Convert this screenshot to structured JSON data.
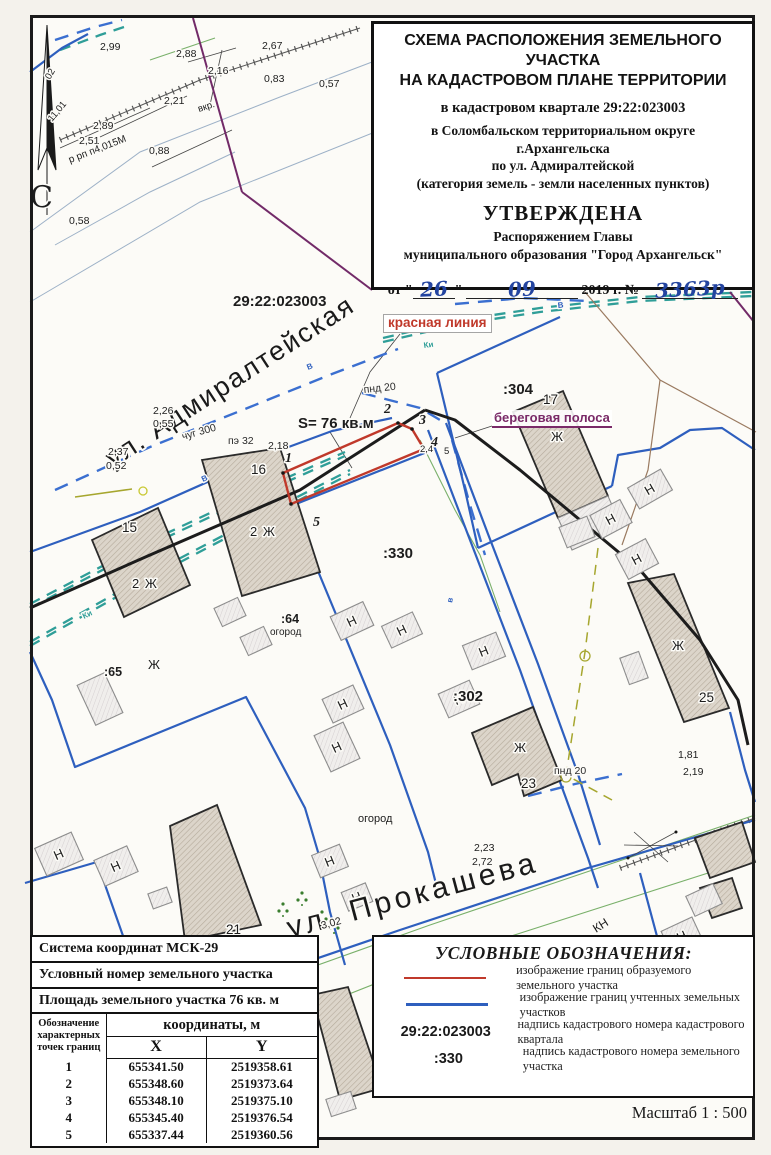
{
  "title_block": {
    "line1": "СХЕМА РАСПОЛОЖЕНИЯ ЗЕМЕЛЬНОГО УЧАСТКА",
    "line2": "НА КАДАСТРОВОМ ПЛАНЕ ТЕРРИТОРИИ",
    "quarter": "в кадастровом квартале 29:22:023003",
    "district": "в Соломбальском территориальном округе",
    "city": "г.Архангельска",
    "street": "по ул. Адмиралтейской",
    "category": "(категория земель - земли населенных пунктов)",
    "approved": "УТВЕРЖДЕНА",
    "order_line1": "Распоряжением Главы",
    "order_line2": "муниципального образования \"Город Архангельск\"",
    "date": {
      "prefix": "от \"",
      "day": "26",
      "quote_close": "\"",
      "month": "09",
      "year_part": "2019 г. №",
      "number": "3363р"
    }
  },
  "callouts": {
    "red_line": "красная линия",
    "shore_strip": "береговая полоса"
  },
  "info_table": {
    "row1": "Система координат МСК-29",
    "row2": "Условный номер земельного участка",
    "row3": "Площадь земельного участка 76 кв. м",
    "col_point": "Обозначение характерных точек границ",
    "col_coords": "координаты, м",
    "col_x": "X",
    "col_y": "Y",
    "points": [
      {
        "n": "1",
        "x": "655341.50",
        "y": "2519358.61"
      },
      {
        "n": "2",
        "x": "655348.60",
        "y": "2519373.64"
      },
      {
        "n": "3",
        "x": "655348.10",
        "y": "2519375.10"
      },
      {
        "n": "4",
        "x": "655345.40",
        "y": "2519376.54"
      },
      {
        "n": "5",
        "x": "655337.44",
        "y": "2519360.56"
      }
    ]
  },
  "legend": {
    "title": "УСЛОВНЫЕ ОБОЗНАЧЕНИЯ:",
    "items": [
      {
        "sample": "red-line",
        "text": "изображение границ образуемого земельного участка"
      },
      {
        "sample": "blue-line",
        "text": "изображение границ учтенных земельных участков"
      },
      {
        "sample": "29:22:023003",
        "text": "надпись кадастрового номера кадастрового квартала"
      },
      {
        "sample": ":330",
        "text": "надпись кадастрового номера земельного участка"
      }
    ]
  },
  "scale_label": "Масштаб  1 : 500",
  "colors": {
    "formed_parcel": "#c0392b",
    "registered_parcel": "#2e5fbe",
    "waterline_teal": "#2f9e98",
    "shore_purple": "#7a2a68",
    "handwriting_blue": "#2344a0"
  },
  "map": {
    "labels": [
      {
        "text": "С",
        "x": 30,
        "y": 207,
        "cls": "north"
      },
      {
        "text": "29:22:023003",
        "x": 233,
        "y": 306,
        "cls": "q"
      },
      {
        "text": "ул. Адмиралтейская",
        "x": 113,
        "y": 468,
        "cls": "street",
        "rot": -33
      },
      {
        "text": "ул. Прокашева",
        "x": 290,
        "y": 938,
        "cls": "street2",
        "rot": -15
      },
      {
        "text": "S= 76 кв.м",
        "x": 298,
        "y": 428,
        "cls": "area"
      },
      {
        "text": ":304",
        "x": 503,
        "y": 394,
        "cls": "q2"
      },
      {
        "text": ":330",
        "x": 383,
        "y": 558,
        "cls": "q2"
      },
      {
        "text": ":302",
        "x": 453,
        "y": 701,
        "cls": "q2"
      },
      {
        "text": ":64",
        "x": 281,
        "y": 623,
        "cls": "q3"
      },
      {
        "text": "огород",
        "x": 270,
        "y": 635,
        "cls": "small"
      },
      {
        "text": ":65",
        "x": 104,
        "y": 676,
        "cls": "q3"
      },
      {
        "text": "огород",
        "x": 358,
        "y": 822,
        "cls": "small2"
      },
      {
        "text": "15",
        "x": 122,
        "y": 532,
        "cls": "hn"
      },
      {
        "text": "16",
        "x": 251,
        "y": 474,
        "cls": "hn"
      },
      {
        "text": "17",
        "x": 543,
        "y": 404,
        "cls": "hn"
      },
      {
        "text": "21",
        "x": 226,
        "y": 934,
        "cls": "hn"
      },
      {
        "text": "23",
        "x": 521,
        "y": 788,
        "cls": "hn"
      },
      {
        "text": "25",
        "x": 699,
        "y": 702,
        "cls": "hn"
      },
      {
        "text": "2 Ж",
        "x": 132,
        "y": 588,
        "cls": "bl"
      },
      {
        "text": "2 Ж",
        "x": 250,
        "y": 536,
        "cls": "bl"
      },
      {
        "text": "Ж",
        "x": 148,
        "y": 669,
        "cls": "bl"
      },
      {
        "text": "Ж",
        "x": 551,
        "y": 441,
        "cls": "bl"
      },
      {
        "text": "Ж",
        "x": 514,
        "y": 752,
        "cls": "bl"
      },
      {
        "text": "Ж",
        "x": 672,
        "y": 650,
        "cls": "bl"
      },
      {
        "text": "1",
        "x": 285,
        "y": 462,
        "cls": "pt"
      },
      {
        "text": "2",
        "x": 384,
        "y": 413,
        "cls": "pt"
      },
      {
        "text": "3",
        "x": 419,
        "y": 424,
        "cls": "pt"
      },
      {
        "text": "4",
        "x": 431,
        "y": 446,
        "cls": "pt"
      },
      {
        "text": "5",
        "x": 313,
        "y": 526,
        "cls": "pt"
      },
      {
        "text": "2,4",
        "x": 420,
        "y": 452,
        "cls": "els"
      },
      {
        "text": "5",
        "x": 444,
        "y": 454,
        "cls": "els"
      },
      {
        "text": "2,18",
        "x": 268,
        "y": 449,
        "cls": "el"
      },
      {
        "text": "2,26",
        "x": 153,
        "y": 414,
        "cls": "el"
      },
      {
        "text": "0,55",
        "x": 153,
        "y": 427,
        "cls": "el"
      },
      {
        "text": "2,37",
        "x": 108,
        "y": 455,
        "cls": "el"
      },
      {
        "text": "0,52",
        "x": 106,
        "y": 469,
        "cls": "el"
      },
      {
        "text": "2,99",
        "x": 100,
        "y": 50,
        "cls": "el"
      },
      {
        "text": "2,88",
        "x": 176,
        "y": 57,
        "cls": "el"
      },
      {
        "text": "2,16",
        "x": 208,
        "y": 74,
        "cls": "el"
      },
      {
        "text": "2,67",
        "x": 262,
        "y": 49,
        "cls": "el"
      },
      {
        "text": "0,83",
        "x": 264,
        "y": 82,
        "cls": "el"
      },
      {
        "text": "0,57",
        "x": 319,
        "y": 87,
        "cls": "el"
      },
      {
        "text": "2,21",
        "x": 164,
        "y": 104,
        "cls": "el"
      },
      {
        "text": "2,89",
        "x": 93,
        "y": 129,
        "cls": "el"
      },
      {
        "text": "2,51",
        "x": 79,
        "y": 144,
        "cls": "el"
      },
      {
        "text": "0,88",
        "x": 149,
        "y": 154,
        "cls": "el"
      },
      {
        "text": "0,58",
        "x": 69,
        "y": 224,
        "cls": "el"
      },
      {
        "text": "11,01",
        "x": 52,
        "y": 122,
        "cls": "els",
        "rot": -50
      },
      {
        "text": "вкр.",
        "x": 199,
        "y": 112,
        "cls": "els",
        "rot": -18
      },
      {
        "text": "р рп п4,015М",
        "x": 70,
        "y": 163,
        "cls": "els2",
        "rot": -21
      },
      {
        "text": "02",
        "x": 50,
        "y": 80,
        "cls": "els",
        "rot": -60
      },
      {
        "text": "1,81",
        "x": 678,
        "y": 758,
        "cls": "el"
      },
      {
        "text": "2,19",
        "x": 683,
        "y": 775,
        "cls": "el"
      },
      {
        "text": "2,23",
        "x": 474,
        "y": 851,
        "cls": "el"
      },
      {
        "text": "2,72",
        "x": 472,
        "y": 865,
        "cls": "el"
      },
      {
        "text": "3,02",
        "x": 322,
        "y": 929,
        "cls": "el",
        "rot": -15
      },
      {
        "text": "чуг 300",
        "x": 183,
        "y": 440,
        "cls": "pipe",
        "rot": -16
      },
      {
        "text": "пэ 32",
        "x": 228,
        "y": 444,
        "cls": "pipe"
      },
      {
        "text": "пнд 20",
        "x": 364,
        "y": 393,
        "cls": "pipe",
        "rot": -6
      },
      {
        "text": "пнд 20",
        "x": 554,
        "y": 774,
        "cls": "pipe"
      },
      {
        "text": "КН",
        "x": 596,
        "y": 933,
        "cls": "pipe2",
        "rot": -32
      },
      {
        "text": "Ки",
        "x": 84,
        "y": 619,
        "cls": "tinyT",
        "rot": -26
      },
      {
        "text": "Ки",
        "x": 424,
        "y": 348,
        "cls": "tinyT",
        "rot": -8
      },
      {
        "text": "В",
        "x": 203,
        "y": 482,
        "cls": "tinyB",
        "rot": -26
      },
      {
        "text": "В",
        "x": 308,
        "y": 370,
        "cls": "tinyB",
        "rot": -22
      },
      {
        "text": "В",
        "x": 558,
        "y": 308,
        "cls": "tinyB",
        "rot": -6
      },
      {
        "text": "в",
        "x": 452,
        "y": 603,
        "cls": "tinyB",
        "rot": -78
      }
    ],
    "small_buildings": [
      {
        "x": 352,
        "y": 621,
        "w": 36,
        "h": 26,
        "rot": -25,
        "label": "Н"
      },
      {
        "x": 402,
        "y": 630,
        "w": 34,
        "h": 24,
        "rot": -25,
        "label": "Н"
      },
      {
        "x": 484,
        "y": 651,
        "w": 36,
        "h": 26,
        "rot": -22,
        "label": "Н"
      },
      {
        "x": 459,
        "y": 699,
        "w": 34,
        "h": 26,
        "rot": -24,
        "label": "Н"
      },
      {
        "x": 343,
        "y": 704,
        "w": 34,
        "h": 26,
        "rot": -25,
        "label": "Н"
      },
      {
        "x": 337,
        "y": 747,
        "w": 32,
        "h": 40,
        "rot": -25,
        "label": "Н"
      },
      {
        "x": 330,
        "y": 861,
        "w": 30,
        "h": 24,
        "rot": -22,
        "label": "Н"
      },
      {
        "x": 357,
        "y": 897,
        "w": 26,
        "h": 20,
        "rot": -22,
        "label": "Н"
      },
      {
        "x": 59,
        "y": 854,
        "w": 40,
        "h": 30,
        "rot": -24,
        "label": "Н"
      },
      {
        "x": 116,
        "y": 866,
        "w": 36,
        "h": 28,
        "rot": -24,
        "label": "Н"
      },
      {
        "x": 650,
        "y": 489,
        "w": 38,
        "h": 24,
        "rot": -30,
        "label": "Н"
      },
      {
        "x": 611,
        "y": 519,
        "w": 34,
        "h": 26,
        "rot": -28,
        "label": "Н"
      },
      {
        "x": 637,
        "y": 559,
        "w": 34,
        "h": 28,
        "rot": -28,
        "label": "Н"
      },
      {
        "x": 682,
        "y": 936,
        "w": 34,
        "h": 26,
        "rot": -25,
        "label": "Н"
      },
      {
        "x": 230,
        "y": 612,
        "w": 26,
        "h": 20,
        "rot": -25,
        "label": ""
      },
      {
        "x": 256,
        "y": 641,
        "w": 26,
        "h": 20,
        "rot": -25,
        "label": ""
      },
      {
        "x": 577,
        "y": 532,
        "w": 30,
        "h": 22,
        "rot": -22,
        "label": ""
      },
      {
        "x": 634,
        "y": 668,
        "w": 20,
        "h": 28,
        "rot": -20,
        "label": ""
      },
      {
        "x": 100,
        "y": 699,
        "w": 30,
        "h": 44,
        "rot": -25,
        "label": ""
      },
      {
        "x": 160,
        "y": 898,
        "w": 20,
        "h": 16,
        "rot": -20,
        "label": ""
      },
      {
        "x": 341,
        "y": 1104,
        "w": 26,
        "h": 18,
        "rot": -18,
        "label": ""
      },
      {
        "x": 704,
        "y": 900,
        "w": 30,
        "h": 22,
        "rot": -25,
        "label": ""
      }
    ]
  }
}
